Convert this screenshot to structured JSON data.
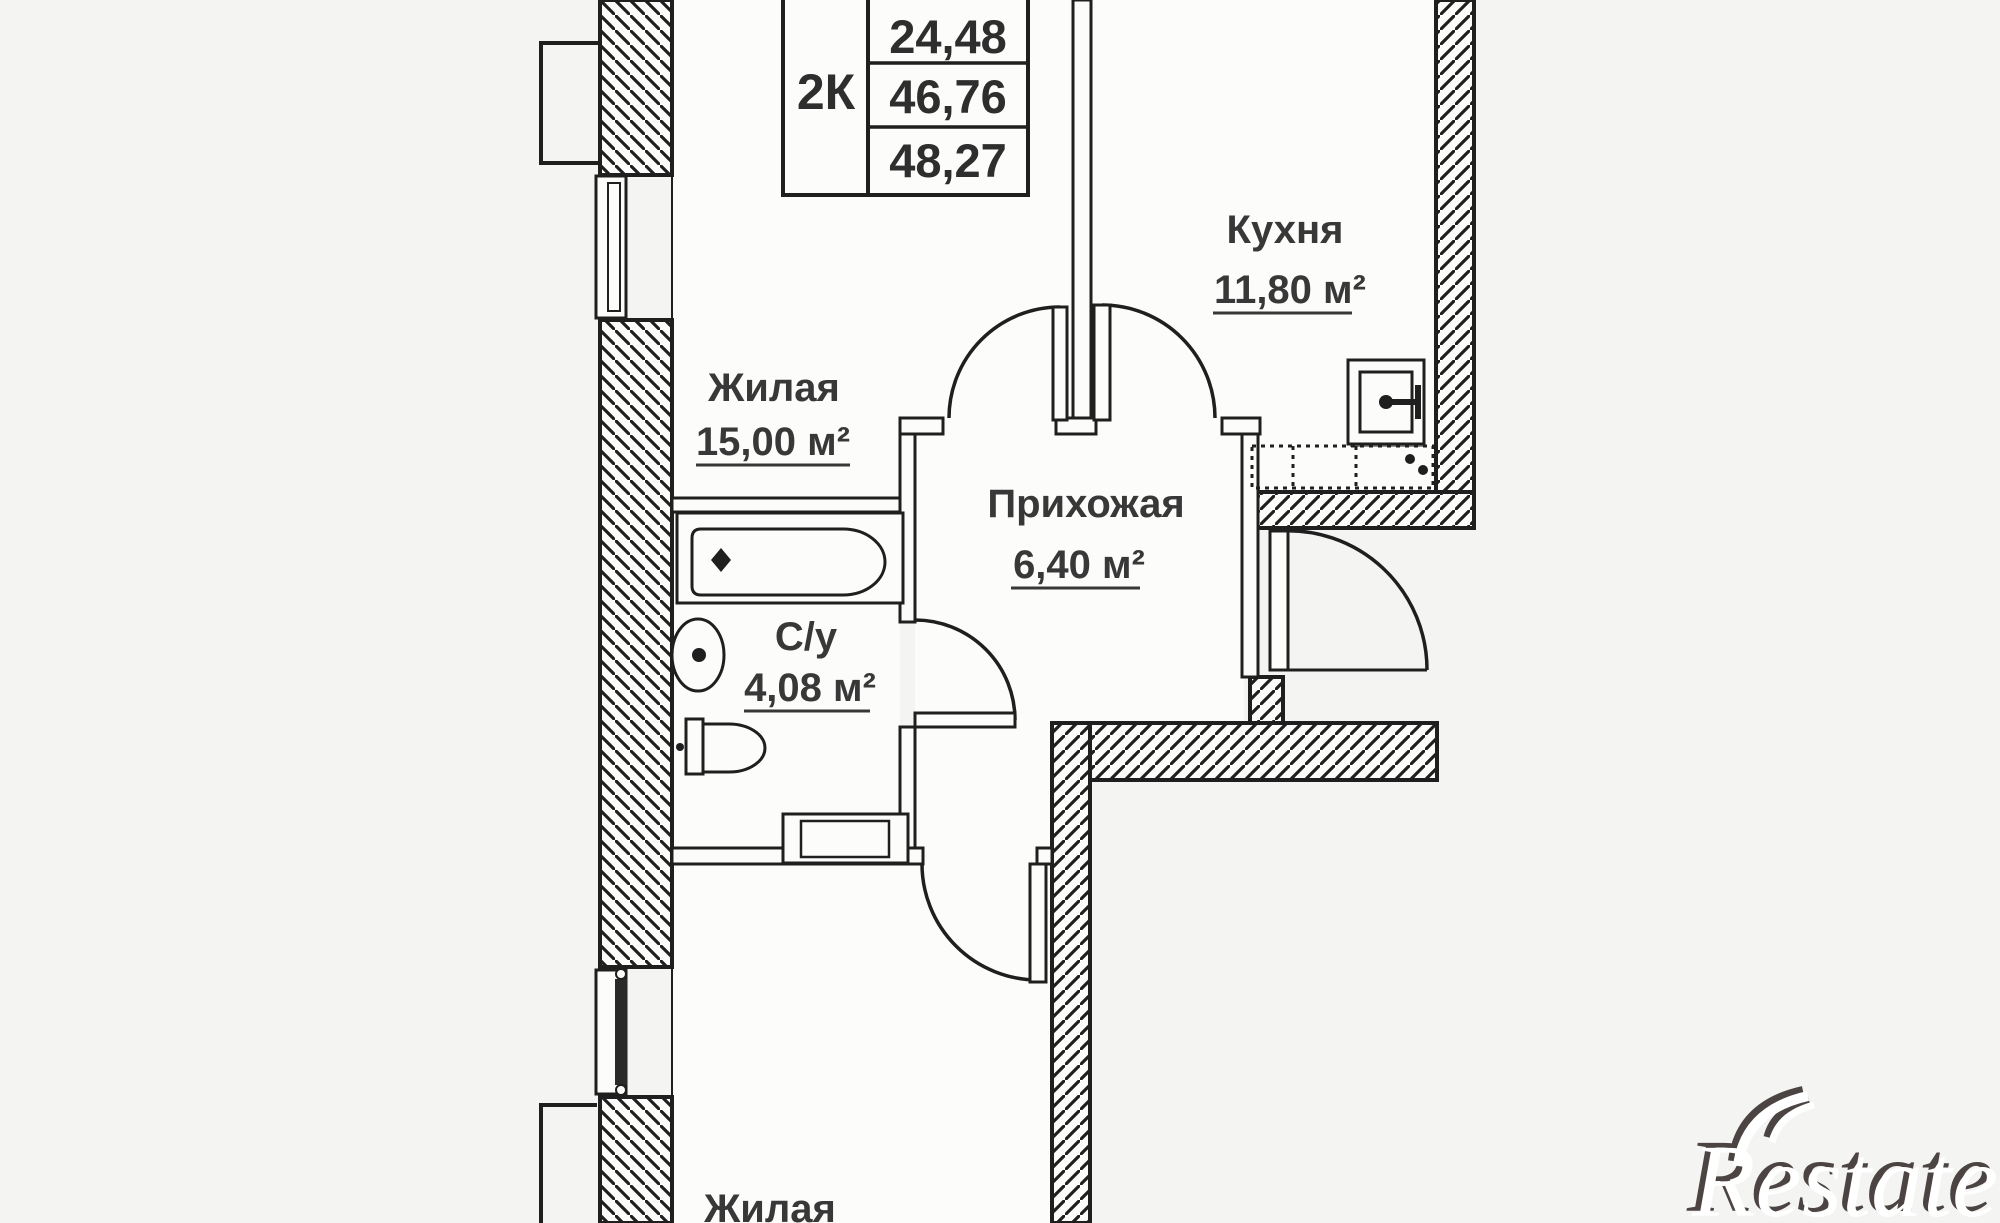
{
  "floorplan": {
    "info_table": {
      "type": "2К",
      "values": [
        "24,48",
        "46,76",
        "48,27"
      ]
    },
    "rooms": {
      "kitchen": {
        "name": "Кухня",
        "area": "11,80 м²"
      },
      "living_top": {
        "name": "Жилая",
        "area": "15,00 м²"
      },
      "hallway": {
        "name": "Прихожая",
        "area": "6,40 м²"
      },
      "bathroom": {
        "name": "С/у",
        "area": "4,08 м²"
      },
      "living_bottom": {
        "name": "Жилая"
      }
    },
    "watermark": "Restate",
    "colors": {
      "background": "#f4f4f3",
      "line": "#1f1f1f",
      "text": "#383838",
      "watermark_fill": "#ffffff",
      "watermark_shadow": "#4b4442"
    }
  }
}
